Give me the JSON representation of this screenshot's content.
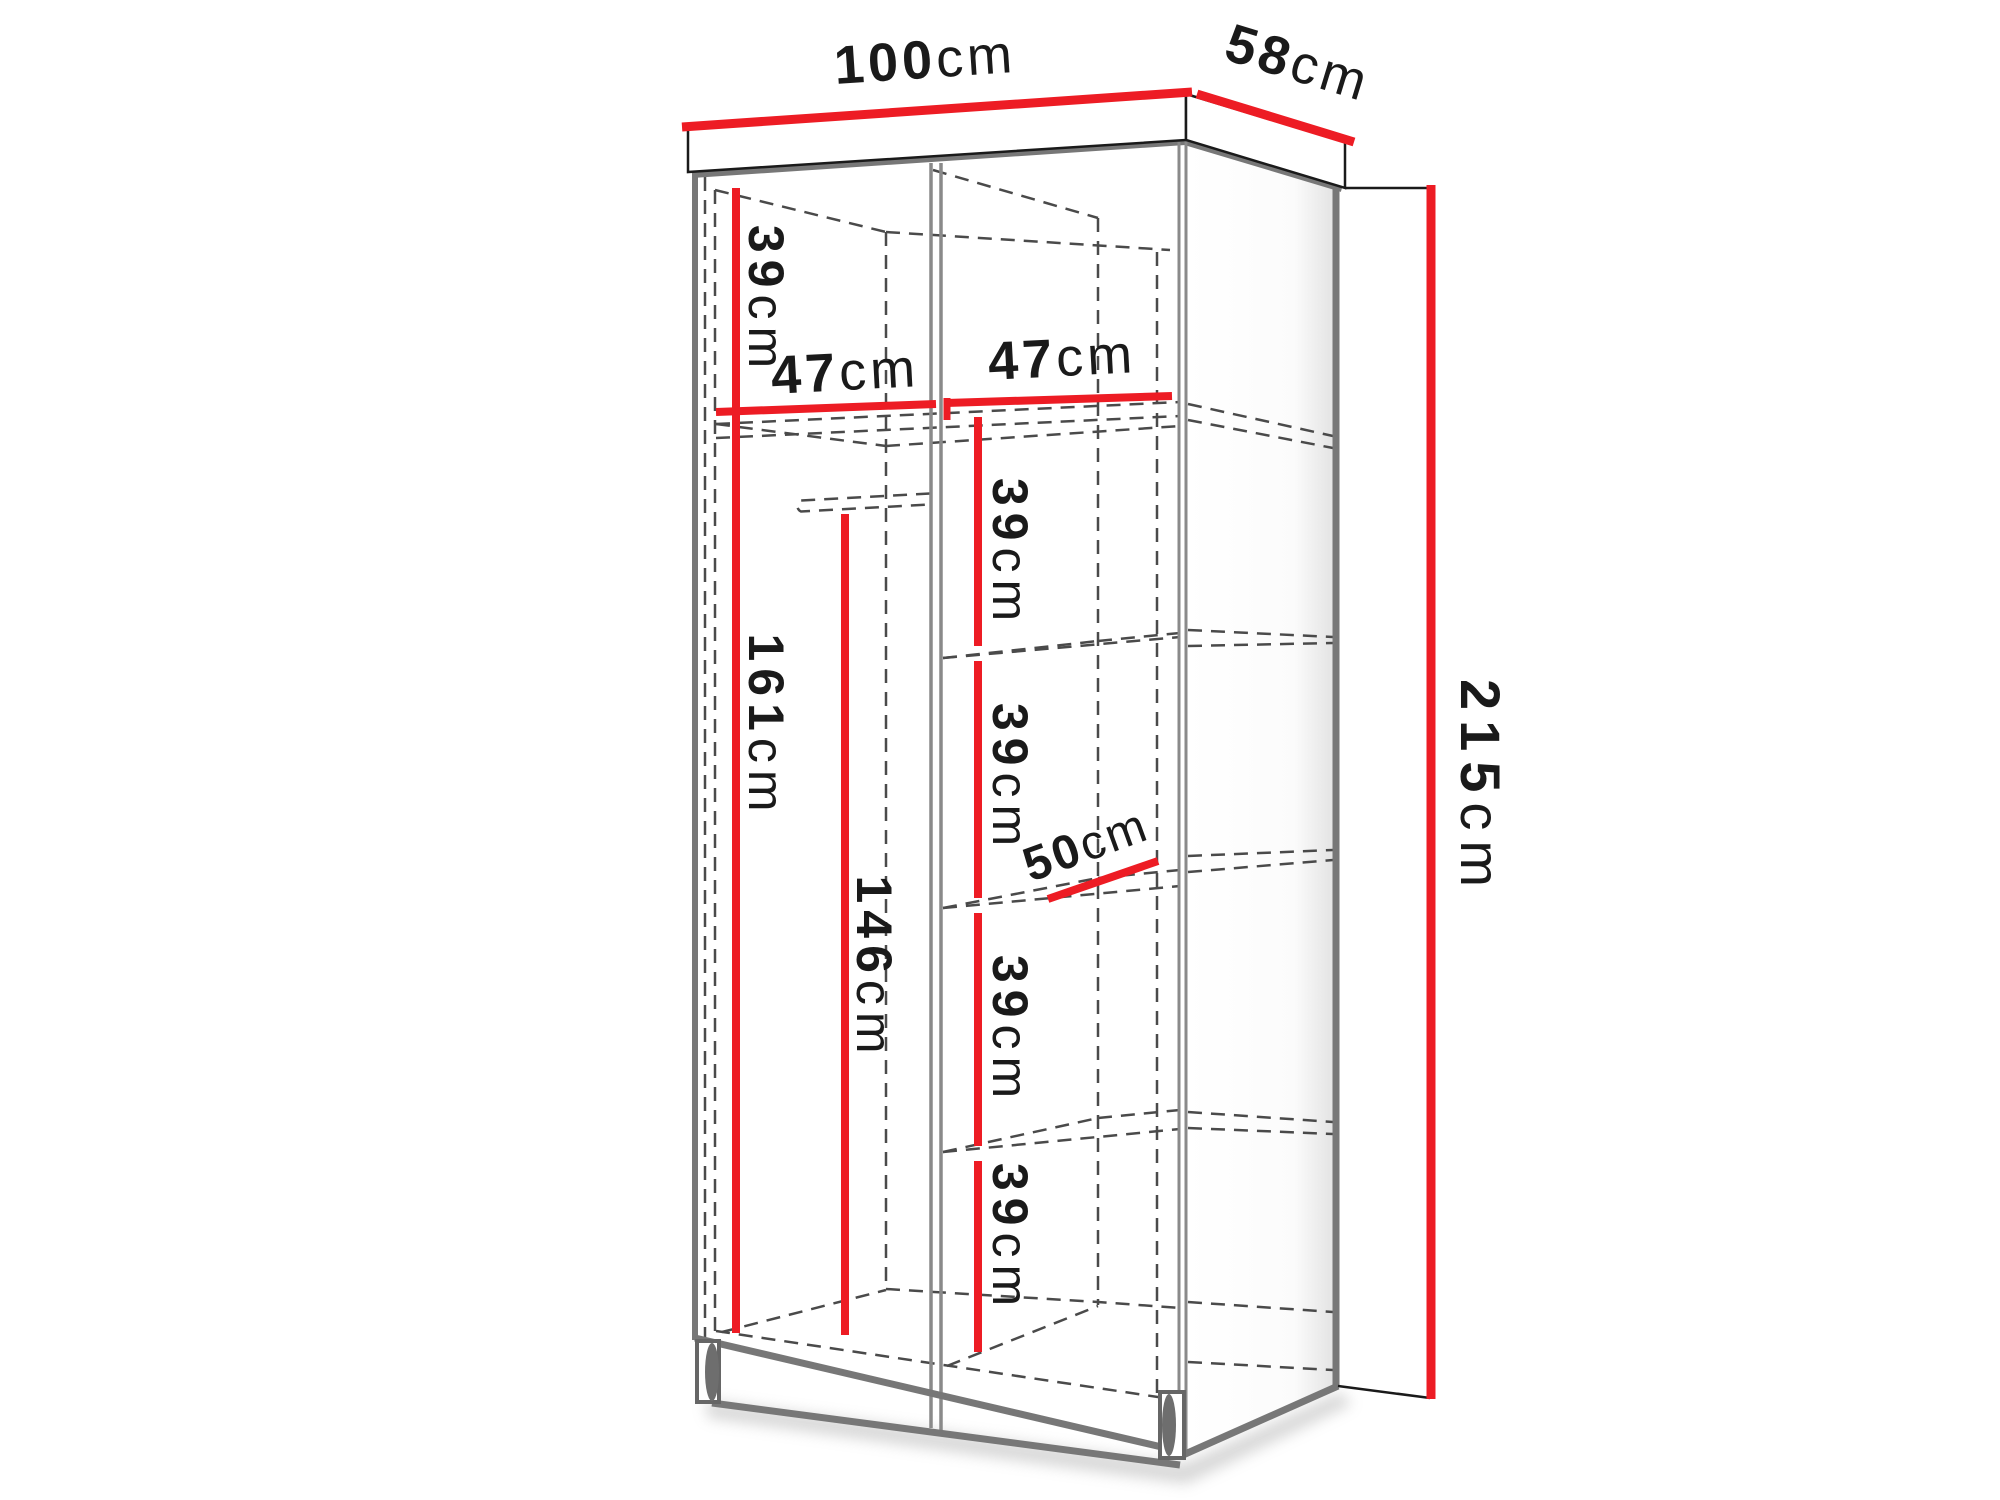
{
  "colors": {
    "dimension_red": "#ed1c24",
    "visible_edge_gray": "#777777",
    "hidden_edge_gray": "#4a4a4a",
    "label_ink": "#1a1a1a"
  },
  "dims": {
    "width": {
      "value": "100",
      "unit": "cm"
    },
    "depth": {
      "value": "58",
      "unit": "cm"
    },
    "height": {
      "value": "215",
      "unit": "cm"
    },
    "top_section": {
      "value": "39",
      "unit": "cm"
    },
    "left_width": {
      "value": "47",
      "unit": "cm"
    },
    "right_width": {
      "value": "47",
      "unit": "cm"
    },
    "gap1": {
      "value": "39",
      "unit": "cm"
    },
    "gap2": {
      "value": "39",
      "unit": "cm"
    },
    "gap3": {
      "value": "39",
      "unit": "cm"
    },
    "gap4": {
      "value": "39",
      "unit": "cm"
    },
    "shelf_depth": {
      "value": "50",
      "unit": "cm"
    },
    "left_height": {
      "value": "161",
      "unit": "cm"
    },
    "rail_height": {
      "value": "146",
      "unit": "cm"
    }
  }
}
